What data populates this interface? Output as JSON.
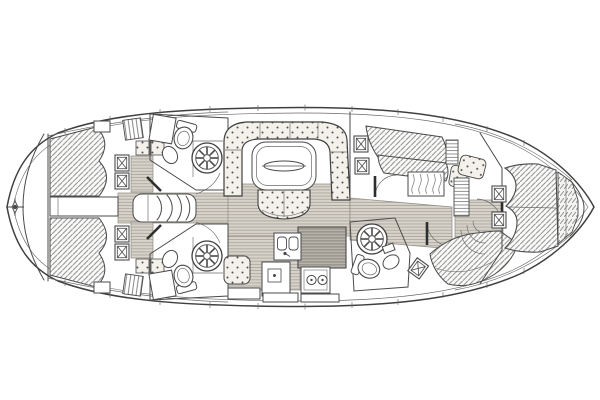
{
  "diagram": {
    "type": "sailing-yacht-interior-layout-plan",
    "title": "Sailing yacht deck / interior layout plan (top view)",
    "orientation": {
      "bow": "right",
      "stern": "left"
    },
    "visible_text": [],
    "palette": {
      "background": "#ffffff",
      "line": "#4a4a4a",
      "wood_sole_fill": "#d7d3ca",
      "wood_sole_line": "#a8a399",
      "berth_hatch_line": "#8f8f8f",
      "upholstery_fill": "#f4f1ea",
      "upholstery_dot": "#4f4f4f",
      "dark_counter_fill": "#b7b3ab",
      "dark_counter_line": "#85817a"
    },
    "areas": {
      "hull": {
        "label": "Hull outline with toe-rail and stanchion ticks"
      },
      "stern_deck": {
        "label": "Stern deck with transom arc and compass rose"
      },
      "aft_cabin_top": {
        "label": "Aft double cabin, top side: hatched berth, louvre locker, cushions, deck hatches"
      },
      "aft_cabin_bottom": {
        "label": "Aft double cabin, bottom side: hatched berth, louvre locker, cushions, deck hatches"
      },
      "companionway": {
        "label": "Companionway steps between the aft cabins"
      },
      "aft_head_top": {
        "label": "Aft head (top): toilet, washbasin, round shower grate"
      },
      "aft_head_bottom": {
        "label": "Aft head (bottom): toilet, washbasin, round shower grate"
      },
      "salon": {
        "label": "Salon: U-shaped dotted settee, folding table with oval leaf, curved stool"
      },
      "galley": {
        "label": "Galley: twin sinks, two-burner stove, fridge box, dark worktop, dotted seat"
      },
      "bunk_cabin_top": {
        "label": "Midship cabin, top side: slanted hatched berths, hanging locker, shelf, seat"
      },
      "forward_head": {
        "label": "Forward head (bottom): shower grate, toilet, basin, tilted deck hatch"
      },
      "forward_berth_bottom": {
        "label": "Forward double berth, bottom side (hatched)"
      },
      "bow_cabin": {
        "label": "Bow cabin with hatched V-berth, infill cushion, centreline hatches"
      },
      "anchor_locker": {
        "label": "Anchor locker at the bow tip"
      }
    },
    "icons": [
      "compass-rose-icon",
      "deck-hatch-icon",
      "shower-grate-icon",
      "toilet-icon",
      "washbasin-icon",
      "twin-sink-icon",
      "stove-burner-icon",
      "fridge-icon",
      "hanging-locker-icon",
      "companionway-steps-icon",
      "salon-table-icon"
    ],
    "counts": {
      "deck_hatches": 9,
      "showers": 3,
      "toilets": 3,
      "berth_areas": 6
    }
  }
}
